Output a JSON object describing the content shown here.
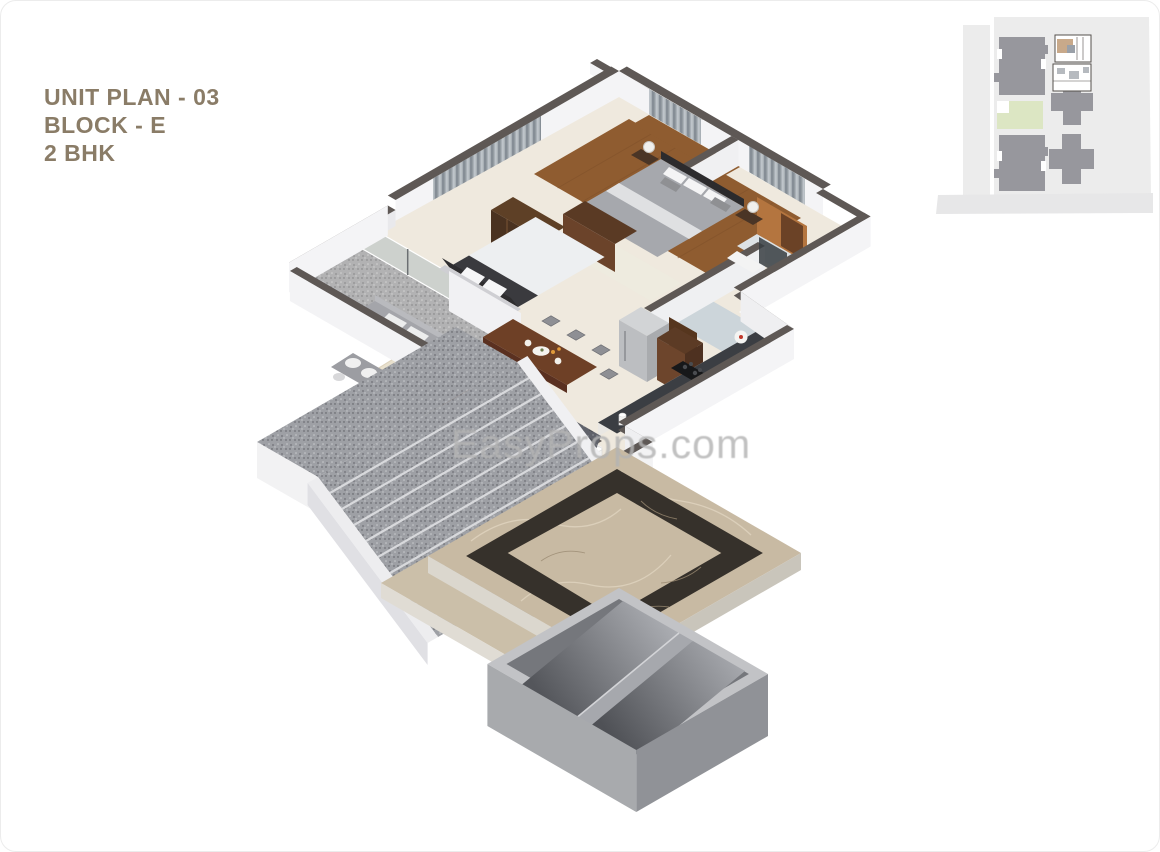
{
  "header": {
    "title_lines": [
      "UNIT PLAN - 03",
      "BLOCK - E",
      "2 BHK"
    ]
  },
  "watermark": {
    "text": "EasyProps.com"
  },
  "plan": {
    "type": "3d-isometric-floor-plan",
    "rooms": [
      "master-bedroom",
      "bedroom-2",
      "living-room",
      "dining-area",
      "kitchen",
      "bathroom",
      "toilet",
      "balcony",
      "entrance-staircase",
      "entrance-marble-deck",
      "lower-stair-shaft"
    ]
  },
  "colors": {
    "title_text": "#8A7C67",
    "watermark": "#B4B4B4",
    "wall_cap": "#5E5855",
    "wall_white": "#F4F4F6",
    "floor_cream": "#EFE9DE",
    "wood_floor": "#8F5C30",
    "granite": "#9EA0A5",
    "marble_beige": "#C8BAA3",
    "marble_inlay": "#36312B",
    "concrete": "#AEB0B3",
    "curtain": "#9198A1",
    "glass": "#A9B8B8",
    "accent_wood": "#B4753F",
    "sofa_gray": "#A4A5AA",
    "furniture_wood": "#6E4026",
    "site_bg": "#ECECEC",
    "site_building": "#97979D",
    "site_green": "#DCE6C3",
    "site_highlight": "#C8A98A"
  }
}
